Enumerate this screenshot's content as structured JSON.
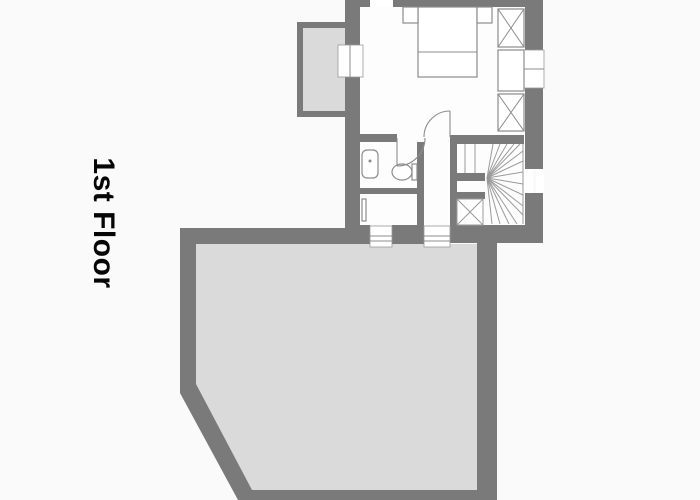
{
  "title": {
    "label": "1st Floor"
  },
  "colors": {
    "background": "#fafafa",
    "wall": "#7a7a7a",
    "room": "#fdfdfd",
    "outdoor": "#dadada",
    "thin": "#8c8c8c",
    "stair": "#9a9a9a",
    "white": "#ffffff",
    "text": "#060606"
  },
  "plan": {
    "canvas": {
      "width": 700,
      "height": 500
    },
    "shapes": [
      {
        "n": "bedroom-floor",
        "kind": "rect",
        "x": 360,
        "y": 7,
        "w": 165,
        "h": 218,
        "fill": "room"
      },
      {
        "n": "terrace-floor",
        "kind": "polygon",
        "points": "196,244 477,244 477,490 251,490 196,387",
        "fill": "outdoor"
      },
      {
        "n": "balcony-floor",
        "kind": "rect",
        "x": 303,
        "y": 28,
        "w": 42,
        "h": 83,
        "fill": "outdoor"
      },
      {
        "n": "top-wall",
        "kind": "rect",
        "x": 345,
        "y": 0,
        "w": 25,
        "h": 7,
        "fill": "wall"
      },
      {
        "n": "top-wall",
        "kind": "rect",
        "x": 393,
        "y": 0,
        "w": 150,
        "h": 7,
        "fill": "wall"
      },
      {
        "n": "left-wall",
        "kind": "rect",
        "x": 345,
        "y": 7,
        "w": 15,
        "h": 38,
        "fill": "wall"
      },
      {
        "n": "left-wall",
        "kind": "rect",
        "x": 345,
        "y": 77,
        "w": 15,
        "h": 151,
        "fill": "wall"
      },
      {
        "n": "right-wall",
        "kind": "rect",
        "x": 525,
        "y": 7,
        "w": 18,
        "h": 43,
        "fill": "wall"
      },
      {
        "n": "right-wall",
        "kind": "rect",
        "x": 525,
        "y": 88,
        "w": 18,
        "h": 81,
        "fill": "wall"
      },
      {
        "n": "right-wall",
        "kind": "rect",
        "x": 525,
        "y": 193,
        "w": 18,
        "h": 50,
        "fill": "wall"
      },
      {
        "n": "bottom-wall",
        "kind": "rect",
        "x": 345,
        "y": 225,
        "w": 25,
        "h": 19,
        "fill": "wall"
      },
      {
        "n": "bottom-wall",
        "kind": "rect",
        "x": 392,
        "y": 225,
        "w": 32,
        "h": 19,
        "fill": "wall"
      },
      {
        "n": "bottom-wall",
        "kind": "rect",
        "x": 450,
        "y": 225,
        "w": 93,
        "h": 18,
        "fill": "wall"
      },
      {
        "n": "terrace-top-wall",
        "kind": "rect",
        "x": 180,
        "y": 228,
        "w": 165,
        "h": 16,
        "fill": "wall"
      },
      {
        "n": "terrace-left-wall",
        "kind": "rect",
        "x": 180,
        "y": 228,
        "w": 16,
        "h": 160,
        "fill": "wall"
      },
      {
        "n": "terrace-chamfer-wall",
        "kind": "polygon",
        "points": "180,384 196,384 252,490 252,500 238,500 180,393",
        "fill": "wall"
      },
      {
        "n": "terrace-bottom-wall",
        "kind": "rect",
        "x": 238,
        "y": 490,
        "w": 259,
        "h": 10,
        "fill": "wall"
      },
      {
        "n": "terrace-right-wall",
        "kind": "rect",
        "x": 477,
        "y": 243,
        "w": 20,
        "h": 257,
        "fill": "wall"
      },
      {
        "n": "balcony-wall",
        "kind": "rect",
        "x": 297,
        "y": 22,
        "w": 48,
        "h": 6,
        "fill": "wall"
      },
      {
        "n": "balcony-wall",
        "kind": "rect",
        "x": 297,
        "y": 22,
        "w": 6,
        "h": 95,
        "fill": "wall"
      },
      {
        "n": "balcony-wall",
        "kind": "rect",
        "x": 297,
        "y": 111,
        "w": 48,
        "h": 6,
        "fill": "wall"
      },
      {
        "n": "bath-top-wall",
        "kind": "rect",
        "x": 360,
        "y": 134,
        "w": 37,
        "h": 8,
        "fill": "wall"
      },
      {
        "n": "stair-top-wall",
        "kind": "rect",
        "x": 450,
        "y": 135,
        "w": 74,
        "h": 9,
        "fill": "wall"
      },
      {
        "n": "bath-hall-wall",
        "kind": "rect",
        "x": 417,
        "y": 142,
        "w": 7,
        "h": 83,
        "fill": "wall"
      },
      {
        "n": "bath-mid-wall",
        "kind": "rect",
        "x": 360,
        "y": 188,
        "w": 64,
        "h": 6,
        "fill": "wall"
      },
      {
        "n": "hall-stair-wall",
        "kind": "rect",
        "x": 450,
        "y": 144,
        "w": 7,
        "h": 83,
        "fill": "wall"
      },
      {
        "n": "stair-newel-wall",
        "kind": "rect",
        "x": 457,
        "y": 173,
        "w": 28,
        "h": 8,
        "fill": "wall"
      },
      {
        "n": "stair-newel-wall",
        "kind": "rect",
        "x": 457,
        "y": 192,
        "w": 28,
        "h": 7,
        "fill": "wall"
      },
      {
        "n": "window-top",
        "kind": "rect",
        "x": 370,
        "y": 0,
        "w": 23,
        "h": 7,
        "fill": "white"
      },
      {
        "n": "window-left",
        "kind": "rect",
        "x": 338,
        "y": 45,
        "w": 25,
        "h": 32,
        "fill": "white",
        "stroke": "stair",
        "sw": 0.8
      },
      {
        "n": "window-left-pane",
        "kind": "line",
        "x1": 350,
        "y1": 45,
        "x2": 350,
        "y2": 77,
        "stroke": "thin",
        "sw": 1
      },
      {
        "n": "window-right-upper",
        "kind": "rect",
        "x": 524,
        "y": 50,
        "w": 20,
        "h": 38,
        "fill": "white",
        "stroke": "stair",
        "sw": 0.8
      },
      {
        "n": "window-right-upper-pane",
        "kind": "line",
        "x1": 524,
        "y1": 69,
        "x2": 544,
        "y2": 69,
        "stroke": "thin",
        "sw": 1
      },
      {
        "n": "window-right-lower",
        "kind": "rect",
        "x": 524,
        "y": 169,
        "w": 9,
        "h": 24,
        "fill": "white"
      },
      {
        "n": "window-right-lower",
        "kind": "rect",
        "x": 536,
        "y": 169,
        "w": 8,
        "h": 24,
        "fill": "white"
      },
      {
        "n": "window-bottom-a",
        "kind": "rect",
        "x": 370,
        "y": 226,
        "w": 22,
        "h": 21,
        "fill": "white",
        "stroke": "stair",
        "sw": 0.8
      },
      {
        "n": "window-bottom-a-pane",
        "kind": "line",
        "x1": 370,
        "y1": 236,
        "x2": 392,
        "y2": 236,
        "stroke": "thin",
        "sw": 1
      },
      {
        "n": "window-bottom-a-pane",
        "kind": "line",
        "x1": 370,
        "y1": 241,
        "x2": 392,
        "y2": 241,
        "stroke": "thin",
        "sw": 1
      },
      {
        "n": "window-bottom-b",
        "kind": "rect",
        "x": 424,
        "y": 226,
        "w": 26,
        "h": 21,
        "fill": "white",
        "stroke": "stair",
        "sw": 0.8
      },
      {
        "n": "window-bottom-b-pane",
        "kind": "line",
        "x1": 424,
        "y1": 236,
        "x2": 450,
        "y2": 236,
        "stroke": "thin",
        "sw": 1
      },
      {
        "n": "window-bottom-b-pane",
        "kind": "line",
        "x1": 424,
        "y1": 241,
        "x2": 450,
        "y2": 241,
        "stroke": "thin",
        "sw": 1
      },
      {
        "n": "stair-edge-line",
        "kind": "line",
        "x1": 523,
        "y1": 144,
        "x2": 523,
        "y2": 224,
        "stroke": "stair",
        "sw": 1
      },
      {
        "n": "stair-tread-line",
        "kind": "line",
        "x1": 465,
        "y1": 144,
        "x2": 465,
        "y2": 173,
        "stroke": "stair",
        "sw": 1
      },
      {
        "n": "stair-tread-line",
        "kind": "line",
        "x1": 475,
        "y1": 144,
        "x2": 475,
        "y2": 173,
        "stroke": "stair",
        "sw": 1
      },
      {
        "n": "stair-fan-line",
        "kind": "line",
        "x1": 487,
        "y1": 178,
        "x2": 493,
        "y2": 144,
        "stroke": "stair",
        "sw": 1
      },
      {
        "n": "stair-fan-line",
        "kind": "line",
        "x1": 487,
        "y1": 178,
        "x2": 500,
        "y2": 144,
        "stroke": "stair",
        "sw": 1
      },
      {
        "n": "stair-fan-line",
        "kind": "line",
        "x1": 487,
        "y1": 178,
        "x2": 507,
        "y2": 144,
        "stroke": "stair",
        "sw": 1
      },
      {
        "n": "stair-fan-line",
        "kind": "line",
        "x1": 487,
        "y1": 178,
        "x2": 514,
        "y2": 144,
        "stroke": "stair",
        "sw": 1
      },
      {
        "n": "stair-fan-line",
        "kind": "line",
        "x1": 487,
        "y1": 178,
        "x2": 520,
        "y2": 144,
        "stroke": "stair",
        "sw": 1
      },
      {
        "n": "stair-fan-line",
        "kind": "line",
        "x1": 487,
        "y1": 178,
        "x2": 523,
        "y2": 151,
        "stroke": "stair",
        "sw": 1
      },
      {
        "n": "stair-fan-line",
        "kind": "line",
        "x1": 487,
        "y1": 178,
        "x2": 523,
        "y2": 161,
        "stroke": "stair",
        "sw": 1
      },
      {
        "n": "stair-fan-line",
        "kind": "line",
        "x1": 487,
        "y1": 178,
        "x2": 523,
        "y2": 172,
        "stroke": "stair",
        "sw": 1
      },
      {
        "n": "stair-fan-line",
        "kind": "line",
        "x1": 487,
        "y1": 178,
        "x2": 523,
        "y2": 184,
        "stroke": "stair",
        "sw": 1
      },
      {
        "n": "stair-fan-line",
        "kind": "line",
        "x1": 487,
        "y1": 178,
        "x2": 523,
        "y2": 195,
        "stroke": "stair",
        "sw": 1
      },
      {
        "n": "stair-fan-line",
        "kind": "line",
        "x1": 487,
        "y1": 178,
        "x2": 523,
        "y2": 206,
        "stroke": "stair",
        "sw": 1
      },
      {
        "n": "stair-fan-line",
        "kind": "line",
        "x1": 487,
        "y1": 178,
        "x2": 523,
        "y2": 215,
        "stroke": "stair",
        "sw": 1
      },
      {
        "n": "stair-fan-line",
        "kind": "line",
        "x1": 487,
        "y1": 178,
        "x2": 517,
        "y2": 224,
        "stroke": "stair",
        "sw": 1
      },
      {
        "n": "stair-fan-line",
        "kind": "line",
        "x1": 487,
        "y1": 178,
        "x2": 509,
        "y2": 224,
        "stroke": "stair",
        "sw": 1
      },
      {
        "n": "stair-fan-line",
        "kind": "line",
        "x1": 487,
        "y1": 178,
        "x2": 500,
        "y2": 224,
        "stroke": "stair",
        "sw": 1
      },
      {
        "n": "stair-fan-line",
        "kind": "line",
        "x1": 487,
        "y1": 178,
        "x2": 492,
        "y2": 224,
        "stroke": "stair",
        "sw": 1
      },
      {
        "n": "stair-entry-box",
        "kind": "rect",
        "x": 457,
        "y": 199,
        "w": 26,
        "h": 26,
        "fill": "white",
        "stroke": "stair",
        "sw": 1
      },
      {
        "n": "stair-entry-cross",
        "kind": "line",
        "x1": 457,
        "y1": 199,
        "x2": 483,
        "y2": 225,
        "stroke": "stair",
        "sw": 1
      },
      {
        "n": "stair-entry-cross",
        "kind": "line",
        "x1": 457,
        "y1": 225,
        "x2": 483,
        "y2": 199,
        "stroke": "stair",
        "sw": 1
      },
      {
        "n": "bed",
        "kind": "rect",
        "x": 418,
        "y": 7,
        "w": 59,
        "h": 70,
        "fill": "white",
        "stroke": "thin",
        "sw": 1.2
      },
      {
        "n": "bed-blanket-line",
        "kind": "line",
        "x1": 418,
        "y1": 52,
        "x2": 477,
        "y2": 52,
        "stroke": "thin",
        "sw": 1
      },
      {
        "n": "nightstand",
        "kind": "rect",
        "x": 403,
        "y": 7,
        "w": 15,
        "h": 16,
        "fill": "white",
        "stroke": "thin",
        "sw": 1.2
      },
      {
        "n": "nightstand",
        "kind": "rect",
        "x": 477,
        "y": 7,
        "w": 15,
        "h": 16,
        "fill": "white",
        "stroke": "thin",
        "sw": 1.2
      },
      {
        "n": "closet",
        "kind": "rect",
        "x": 498,
        "y": 9,
        "w": 26,
        "h": 38,
        "fill": "white",
        "stroke": "thin",
        "sw": 1.2
      },
      {
        "n": "closet-cross",
        "kind": "line",
        "x1": 498,
        "y1": 9,
        "x2": 524,
        "y2": 47,
        "stroke": "thin",
        "sw": 1
      },
      {
        "n": "closet-cross",
        "kind": "line",
        "x1": 498,
        "y1": 47,
        "x2": 524,
        "y2": 9,
        "stroke": "thin",
        "sw": 1
      },
      {
        "n": "closet",
        "kind": "rect",
        "x": 498,
        "y": 50,
        "w": 26,
        "h": 41,
        "fill": "white",
        "stroke": "thin",
        "sw": 1.2
      },
      {
        "n": "closet",
        "kind": "rect",
        "x": 498,
        "y": 94,
        "w": 26,
        "h": 37,
        "fill": "white",
        "stroke": "thin",
        "sw": 1.2
      },
      {
        "n": "closet-cross",
        "kind": "line",
        "x1": 498,
        "y1": 94,
        "x2": 524,
        "y2": 131,
        "stroke": "thin",
        "sw": 1
      },
      {
        "n": "closet-cross",
        "kind": "line",
        "x1": 498,
        "y1": 131,
        "x2": 524,
        "y2": 94,
        "stroke": "thin",
        "sw": 1
      },
      {
        "n": "sink",
        "kind": "rect",
        "x": 362,
        "y": 150,
        "w": 16,
        "h": 28,
        "rx": 5,
        "fill": "white",
        "stroke": "thin",
        "sw": 1.2
      },
      {
        "n": "sink-faucet",
        "kind": "circle",
        "cx": 370,
        "cy": 161,
        "r": 1.5,
        "fill": "thin"
      },
      {
        "n": "toilet-bowl",
        "kind": "ellipse",
        "cx": 402,
        "cy": 172,
        "rx": 10,
        "ry": 8,
        "fill": "white",
        "stroke": "thin",
        "sw": 1.2
      },
      {
        "n": "toilet-tank",
        "kind": "rect",
        "x": 412,
        "y": 164,
        "w": 5,
        "h": 16,
        "fill": "white",
        "stroke": "thin",
        "sw": 1.2
      },
      {
        "n": "radiator",
        "kind": "rect",
        "x": 362,
        "y": 199,
        "w": 4,
        "h": 22,
        "fill": "white",
        "stroke": "thin",
        "sw": 1.2
      },
      {
        "n": "bathroom-door-arc",
        "kind": "path",
        "d": "M425,138 A28,28 0 0 1 397,166",
        "fill": "none",
        "stroke": "thin",
        "sw": 1.1
      },
      {
        "n": "bathroom-door-leaf",
        "kind": "line",
        "x1": 397,
        "y1": 138,
        "x2": 397,
        "y2": 166,
        "stroke": "thin",
        "sw": 1.1
      },
      {
        "n": "bedroom-door-arc",
        "kind": "path",
        "d": "M424,137 A26,26 0 0 1 450,111",
        "fill": "none",
        "stroke": "thin",
        "sw": 1.1
      },
      {
        "n": "bedroom-door-leaf",
        "kind": "line",
        "x1": 450,
        "y1": 111,
        "x2": 450,
        "y2": 137,
        "stroke": "thin",
        "sw": 1.1
      }
    ]
  }
}
